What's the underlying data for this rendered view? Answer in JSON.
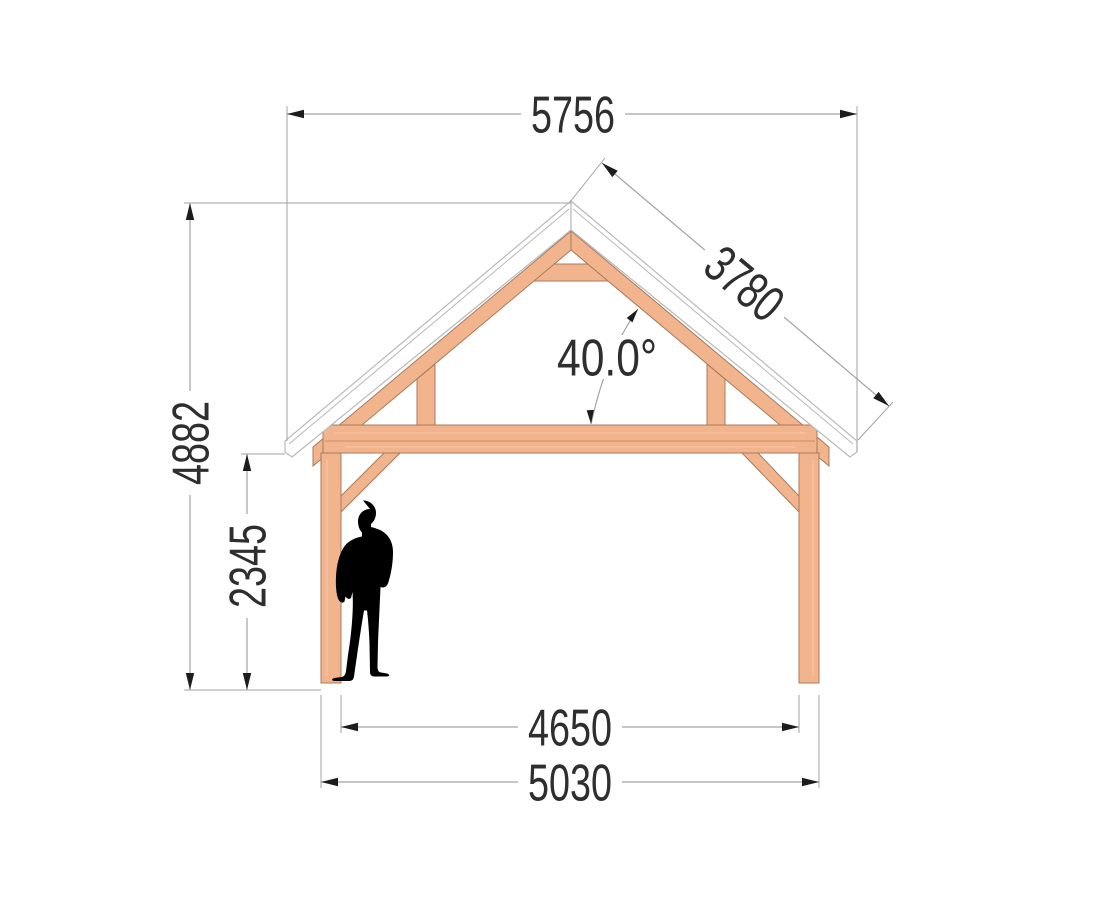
{
  "dimensions": {
    "overall_width": "5756",
    "rafter_length": "3780",
    "roof_angle": "40.0°",
    "overall_height": "4882",
    "clearance_height": "2345",
    "inner_span": "4650",
    "outer_span": "5030"
  },
  "colors": {
    "wood": "#f1b48d",
    "wood-edge": "#a87a5c",
    "wood-grain": "#f7c9a8",
    "wood-joint": "#c98f6b",
    "roof-fill": "#ffffff",
    "roof-edge": "#b9b9b9",
    "dim-line": "#a3a3a3",
    "arrow": "#1c1c1c",
    "dim-text": "#2e2e2e",
    "figure": "#000000"
  }
}
